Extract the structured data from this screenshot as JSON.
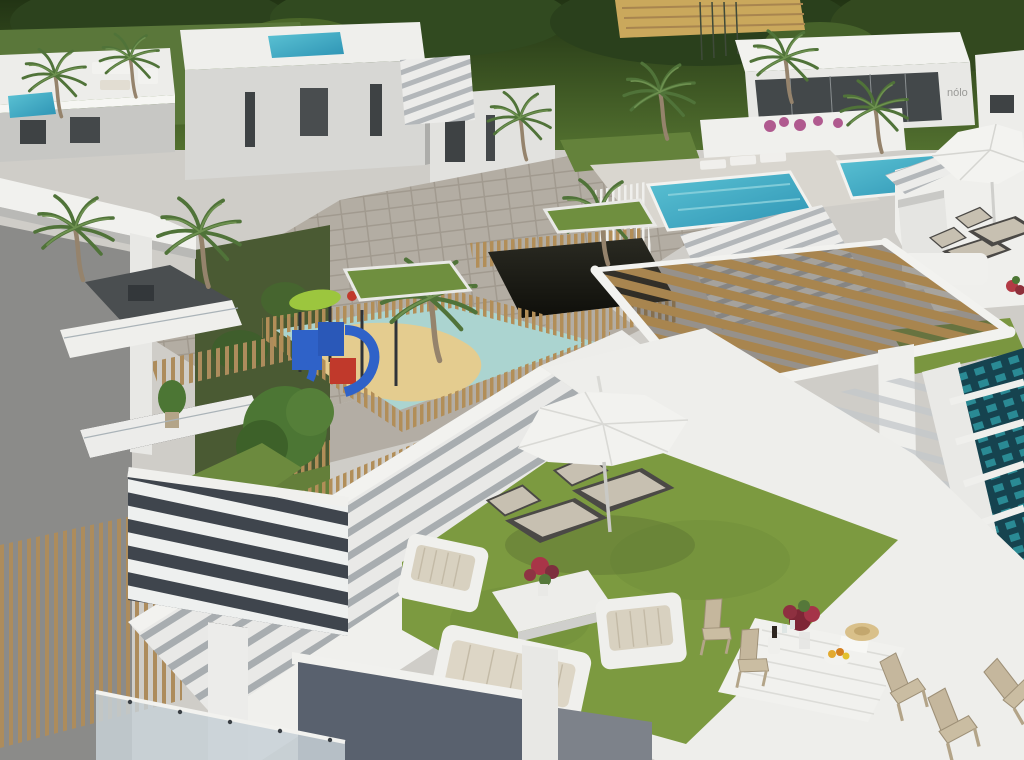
{
  "meta": {
    "title": "Aerial 3D architectural render of a modern white residential complex",
    "style": "photorealistic CGI, bird's-eye view, daytime"
  },
  "branding": {
    "sales_office_logo": "nólo"
  },
  "palette": {
    "trees_dark": "#2c421d",
    "lawn": "#64823b",
    "terrace_grass": "#7c9a40",
    "grass_shade": "#6f8d39",
    "water": "#41aabe",
    "water_light": "#8fd4de",
    "lap_pool": "#16434f",
    "lap_tile": "#2e97a0",
    "building_white": "#f2f2ef",
    "building_shade": "#c9c9c6",
    "concrete": "#8b8b89",
    "paving": "#b3ada3",
    "wood": "#b0905f",
    "wood_dark": "#6b5838",
    "sand": "#e4cc8f",
    "splash_pad": "#abd4d0",
    "equip_blue": "#2f62c8",
    "equip_red": "#c0392b",
    "canopy_green": "#9cc63e",
    "wall_blue_gray": "#59616e",
    "step_shadow": "#a8adb0",
    "cushion": "#c7c0b1",
    "glass_dark": "#43484a",
    "flower_red": "#a93548",
    "bougainvillea": "#b05a8f"
  },
  "scene": {
    "regions": [
      {
        "id": "background-trees",
        "label": "Dense dark-green trees behind the complex"
      },
      {
        "id": "upper-left-villas",
        "label": "White villas with rooftop terraces and private plunge pools"
      },
      {
        "id": "sales-office",
        "label": "White sales office with dark glass front and logo sign"
      },
      {
        "id": "community-pools",
        "label": "Two turquoise community pools with white sun loungers"
      },
      {
        "id": "plaza",
        "label": "Paved communal plaza with palm trees in grass planters"
      },
      {
        "id": "garage-ramp",
        "label": "Dark garage ramp fenced with timber slats"
      },
      {
        "id": "playground",
        "label": "Children's playground with blue slide, sand and picket fence"
      },
      {
        "id": "left-apartment-building",
        "label": "Gray apartment building with balconies and timber screen"
      },
      {
        "id": "wood-pergola-roof",
        "label": "Large timber-slat pergola over a roof terrace"
      },
      {
        "id": "lap-pool",
        "label": "Dark tiled lap pool at the right edge"
      },
      {
        "id": "grand-staircase",
        "label": "Wide white external staircase"
      },
      {
        "id": "roof-terrace",
        "label": "Foreground roof terrace with artificial lawn, parasol, loungers, lounge set and dining set"
      }
    ]
  }
}
